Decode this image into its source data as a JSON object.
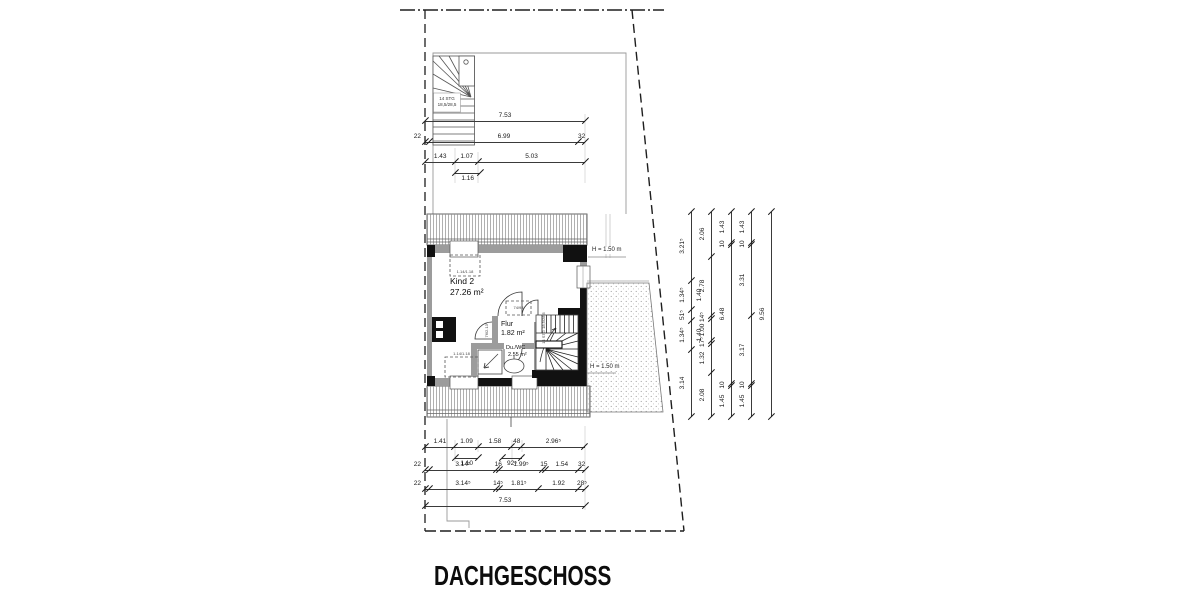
{
  "title": "DACHGESCHOSS",
  "rooms": {
    "kind2": {
      "name": "Kind 2",
      "area": "27.26 m²"
    },
    "flur": {
      "name": "Flur",
      "area": "1.82 m²"
    },
    "duwc": {
      "name": "Du./WC",
      "area": "2.55 m²"
    }
  },
  "height_labels": {
    "upper": "H = 1.50 m",
    "lower": "H = 1.50 m"
  },
  "stairs": {
    "top_label_line1": "14 STG",
    "top_label_line2": "18,5/28,5",
    "inner_label": "14 STG 18,5/28,5"
  },
  "annotations": {
    "skylight_top": "1.14/1.18",
    "skylight_bottom": "1.14/1.18",
    "skylight_flur": "74/98",
    "door_label": "76/2.13⁵"
  },
  "colors": {
    "wall_gray": "#9c9c9c",
    "black": "#111111",
    "line": "#222222"
  },
  "dimensions": {
    "scales": {
      "h": 21.25,
      "v": 21.44
    },
    "chains": [
      {
        "id": "top-total",
        "axis": "h",
        "x": 425,
        "y": 121,
        "segs": [
          {
            "m": 7.53,
            "l": "7.53"
          }
        ]
      },
      {
        "id": "top-outer",
        "axis": "h",
        "x": 425,
        "y": 142,
        "segs": [
          {
            "m": 0.22,
            "l": "22",
            "dx": -10
          },
          {
            "m": 6.99,
            "l": "6.99"
          },
          {
            "m": 0.32,
            "l": "32"
          }
        ]
      },
      {
        "id": "top-inner",
        "axis": "h",
        "x": 425,
        "y": 162,
        "segs": [
          {
            "m": 1.43,
            "l": "1.43"
          },
          {
            "m": 1.07,
            "l": "1.07"
          },
          {
            "m": 5.03,
            "l": "5.03"
          }
        ]
      },
      {
        "id": "top-sec",
        "axis": "h",
        "x": 455.4,
        "y": 173,
        "side": "below",
        "segs": [
          {
            "m": 1.16,
            "l": "1.16"
          }
        ]
      },
      {
        "id": "bot-1",
        "axis": "h",
        "x": 425,
        "y": 447,
        "segs": [
          {
            "m": 1.41,
            "l": "1.41"
          },
          {
            "m": 1.09,
            "l": "1.09"
          },
          {
            "m": 1.58,
            "l": "1.58"
          },
          {
            "m": 0.48,
            "l": "48"
          },
          {
            "m": 2.965,
            "l": "2.96⁵"
          }
        ]
      },
      {
        "id": "bot-1b",
        "axis": "h",
        "x": 455,
        "y": 458,
        "side": "below",
        "segs": [
          {
            "m": 1.1,
            "l": "1.10"
          }
        ]
      },
      {
        "id": "bot-1c",
        "axis": "h",
        "x": 502.2,
        "y": 458,
        "side": "below",
        "segs": [
          {
            "m": 0.925,
            "l": "92⁵"
          }
        ]
      },
      {
        "id": "bot-2",
        "axis": "h",
        "x": 425,
        "y": 470,
        "segs": [
          {
            "m": 0.22,
            "l": "22",
            "dx": -10
          },
          {
            "m": 3.145,
            "l": "3.14⁵"
          },
          {
            "m": 0.16,
            "l": "16"
          },
          {
            "m": 1.995,
            "l": "1.99⁵"
          },
          {
            "m": 0.15,
            "l": "15"
          },
          {
            "m": 1.54,
            "l": "1.54"
          },
          {
            "m": 0.32,
            "l": "32"
          }
        ]
      },
      {
        "id": "bot-3",
        "axis": "h",
        "x": 425,
        "y": 489,
        "segs": [
          {
            "m": 0.22,
            "l": "22",
            "dx": -10
          },
          {
            "m": 3.145,
            "l": "3.14⁵"
          },
          {
            "m": 0.145,
            "l": "14⁵"
          },
          {
            "m": 1.815,
            "l": "1.81⁵"
          },
          {
            "m": 1.92,
            "l": "1.92"
          },
          {
            "m": 0.285,
            "l": "28⁵"
          }
        ]
      },
      {
        "id": "bot-total",
        "axis": "h",
        "x": 425,
        "y": 506,
        "segs": [
          {
            "m": 7.53,
            "l": "7.53"
          }
        ]
      },
      {
        "id": "right-1",
        "axis": "v",
        "x": 691,
        "y": 212,
        "segs": [
          {
            "m": 3.215,
            "l": "3.21⁵"
          },
          {
            "m": 1.345,
            "l": "1.34⁵"
          },
          {
            "m": 0.515,
            "l": "51⁵"
          },
          {
            "m": 1.345,
            "l": "1.34⁵"
          },
          {
            "m": 3.14,
            "l": "3.14"
          }
        ]
      },
      {
        "id": "right-2",
        "axis": "v",
        "x": 711,
        "y": 212,
        "segs": [
          {
            "m": 2.06,
            "l": "2.06"
          },
          {
            "m": 2.78,
            "l": "2.78"
          },
          {
            "m": 0.145,
            "l": "14⁵"
          },
          {
            "m": 1.0,
            "l": "1.00"
          },
          {
            "m": 0.175,
            "l": "17⁵"
          },
          {
            "m": 1.32,
            "l": "1.32"
          },
          {
            "m": 2.08,
            "l": "2.08"
          }
        ]
      },
      {
        "id": "right-3",
        "axis": "v",
        "x": 731,
        "y": 212,
        "segs": [
          {
            "m": 1.43,
            "l": "1.43"
          },
          {
            "m": 0.1,
            "l": "10"
          },
          {
            "m": 6.48,
            "l": "6.48"
          },
          {
            "m": 0.1,
            "l": "10"
          },
          {
            "m": 1.45,
            "l": "1.45"
          }
        ]
      },
      {
        "id": "right-4",
        "axis": "v",
        "x": 751,
        "y": 212,
        "segs": [
          {
            "m": 1.43,
            "l": "1.43"
          },
          {
            "m": 0.1,
            "l": "10"
          },
          {
            "m": 3.31,
            "l": "3.31"
          },
          {
            "m": 3.17,
            "l": "3.17"
          },
          {
            "m": 0.1,
            "l": "10"
          },
          {
            "m": 1.45,
            "l": "1.45"
          }
        ]
      },
      {
        "id": "right-total",
        "axis": "v",
        "x": 771,
        "y": 212,
        "segs": [
          {
            "m": 9.56,
            "l": "9.56"
          }
        ]
      }
    ],
    "extra_labels": [
      {
        "x": 700,
        "y": 295,
        "t": "1.40"
      },
      {
        "x": 700,
        "y": 335,
        "t": "1.40"
      }
    ]
  }
}
